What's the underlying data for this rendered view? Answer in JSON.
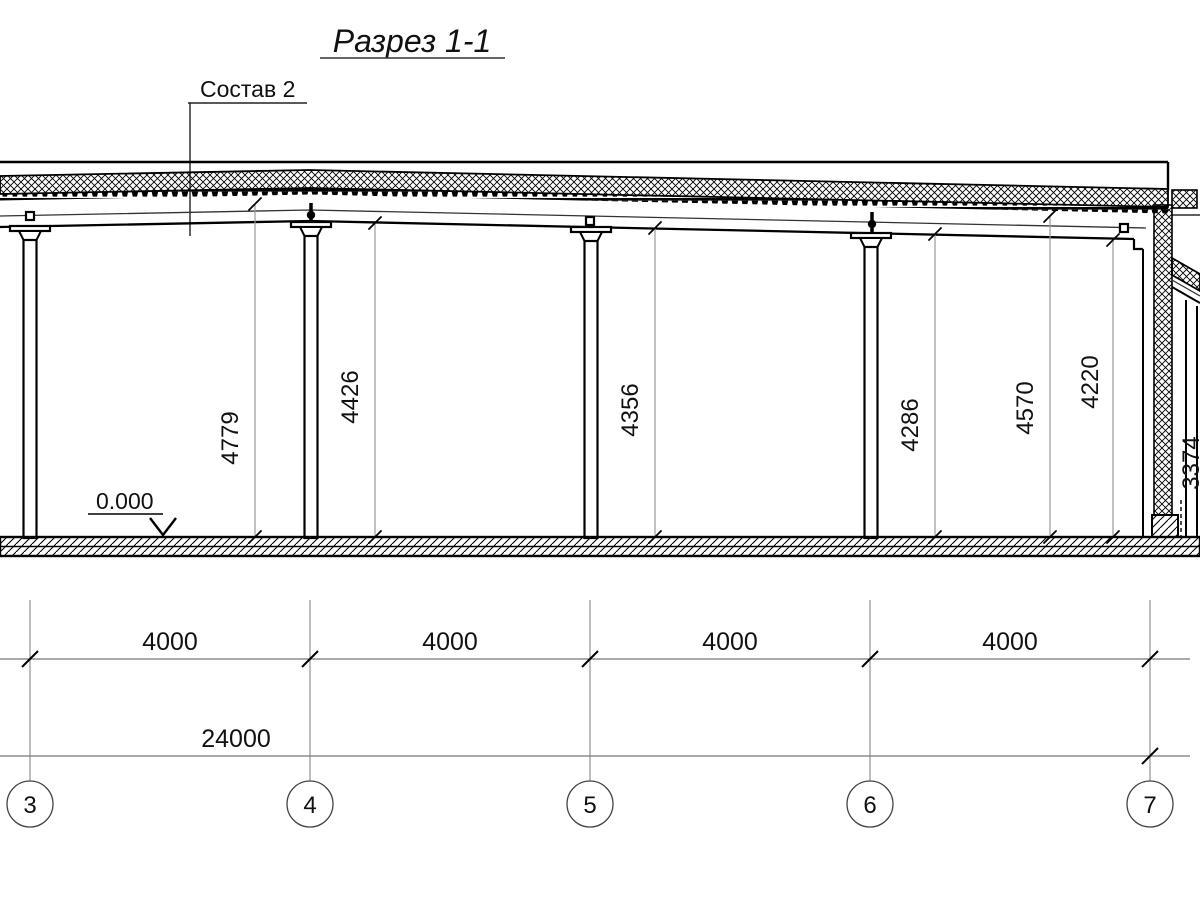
{
  "drawing": {
    "title": "Разрез 1-1",
    "callout_label": "Состав 2",
    "level_mark": "0.000",
    "height_dimensions": [
      "4779",
      "4426",
      "4356",
      "4286",
      "4570",
      "4220"
    ],
    "partial_height_dimension": "3374",
    "bay_dimensions": [
      "4000",
      "4000",
      "4000",
      "4000"
    ],
    "total_dimension": "24000",
    "grid_axes": [
      "3",
      "4",
      "5",
      "6",
      "7"
    ],
    "colors": {
      "line_main": "#000000",
      "line_thin": "#777777",
      "background": "#ffffff"
    }
  }
}
